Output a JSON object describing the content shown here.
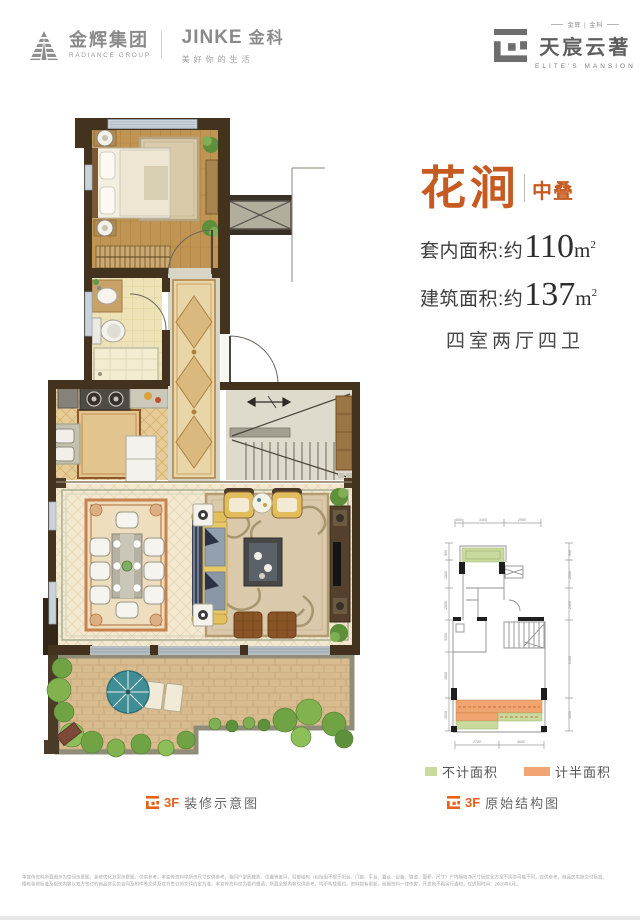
{
  "header": {
    "radiance_cn": "金辉集团",
    "radiance_en": "RADIANCE GROUP",
    "jinke_en": "JINKE",
    "jinke_cn": "金科",
    "jinke_slogan": "美好你的生活",
    "mansion_top": "金辉 | 金科",
    "mansion_cn": "天宸云著",
    "mansion_en": "ELITE'S MANSION"
  },
  "info": {
    "title": "花涧",
    "badge": "中叠",
    "area1_label": "套内面积:约",
    "area1_value": "110",
    "area1_unit": "m",
    "area1_sup": "2",
    "area2_label": "建筑面积:约",
    "area2_value": "137",
    "area2_unit": "m",
    "area2_sup": "2",
    "layout": "四室两厅四卫"
  },
  "captions": {
    "left_floor": "3F",
    "left_label": "装修示意图",
    "right_floor": "3F",
    "right_label": "原始结构图"
  },
  "legend": {
    "not_counted": "不计面积",
    "half_counted": "计半面积",
    "green": "#c9da9e",
    "orange": "#f2a571"
  },
  "schematic": {
    "dims_top": [
      "650",
      "3400",
      "2950"
    ],
    "dims_left": [
      "900",
      "2800",
      "2850",
      "3300",
      "4800",
      "3000"
    ],
    "dims_right": [
      "900",
      "2600",
      "2600",
      "6400",
      "3000"
    ],
    "dims_bottom": [
      "2700",
      "3600"
    ]
  },
  "colors": {
    "accent_orange": "#c65a20",
    "caption_orange": "#e8611c",
    "logo_gray": "#8a8a8a"
  },
  "disclaimer": {
    "line1": "本宣传资料所载图示为空间示意图，装修优化方案示意图，仅供参考。本宣传资料中所示尺寸仅供参考，相同户型因楼栋、位置等差异，局部结构（包括但不限于阳台、门窗、平台、露台、设备、管道、面积、尺寸）户内隔墙净尺寸因优化方案不同亦可能不同，仅供参考，商品房实际交付标准、",
    "line2": "楼栋装修标准及相关内容以双方签订的商品房买卖合同及附件等文件及双方签订的文件约定为准。本宣传资料仅为要约邀请，所载全部内容仅供参考，均不构成要约。资料如有更新，前期资料一律作废，开发商不再另行通知，仅适用时间：2020年6月。"
  }
}
